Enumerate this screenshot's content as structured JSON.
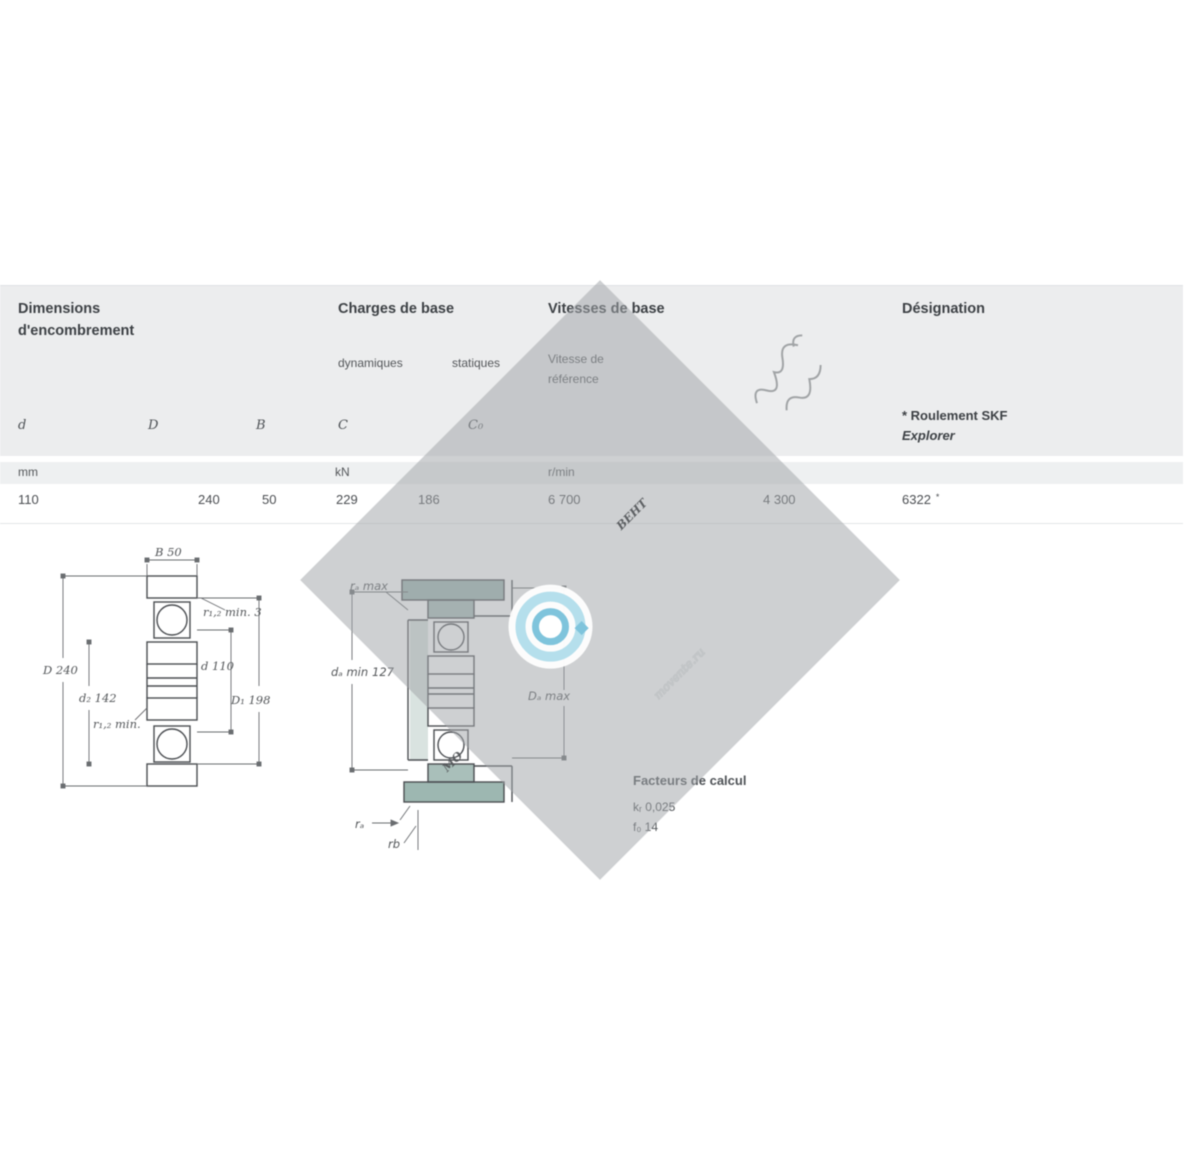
{
  "table": {
    "boundary_title_line1": "Dimensions",
    "boundary_title_line2": "d'encombrement",
    "loads_title": "Charges de base",
    "loads_sub_dynamic": "dynamiques",
    "loads_sub_static": "statiques",
    "speeds_title": "Vitesses de base",
    "speeds_sub_line1": "Vitesse de",
    "speeds_sub_line2": "référence",
    "designation_title": "Désignation",
    "note_line1": "* Roulement SKF",
    "note_line2": "Explorer",
    "symbols": {
      "d": "d",
      "D": "D",
      "B": "B",
      "C": "C",
      "C0": "C₀"
    },
    "units": {
      "dimensions": "mm",
      "loads": "kN",
      "speeds": "r/min"
    },
    "row": {
      "d": "110",
      "D": "240",
      "B": "50",
      "C": "229",
      "C0": "186",
      "speed_reference": "6 700",
      "speed_limiting": "4 300",
      "designation": "6322",
      "star": "*"
    }
  },
  "drawings": {
    "left": {
      "B": "B 50",
      "r12": "r₁,₂ min. 3",
      "D": "D 240",
      "d2": "d₂ 142",
      "r12_inner": "r₁,₂ min.",
      "d": "d 110",
      "D1": "D₁ 198"
    },
    "middle": {
      "ra_max": "rₐ max",
      "da_min": "dₐ min",
      "da_value": "127",
      "Da_max": "Dₐ max",
      "ra": "rₐ",
      "rb": "rb"
    }
  },
  "calc": {
    "title": "Facteurs de calcul",
    "kr": "kᵣ 0,025",
    "f0": "f₀ 14"
  },
  "watermark": {
    "brand_left": "МО",
    "brand_right": "ВЕНТ",
    "domain": "movente.ru"
  },
  "colors": {
    "header_band": "#ecedee",
    "units_band": "#eef0f1",
    "drawing_teal": "#a9bfba",
    "watermark_grey": "#a2a5a8",
    "emblem_blue": "#7fc4dc",
    "emblem_blue_light": "#b5dfec"
  }
}
